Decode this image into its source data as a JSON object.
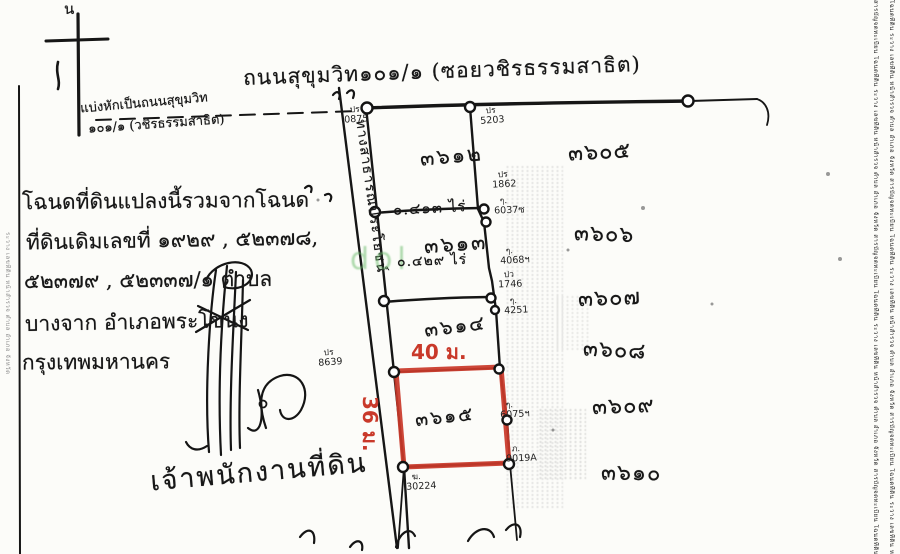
{
  "north_label": "น",
  "road_label": "ถนนสุขุมวิท๑๐๑/๑ (ซอยวชิรธรรมสาธิต)",
  "split_note": {
    "line1": "แบ่งหักเป็นถนนสุขุมวิท",
    "line2": "๑๐๑/๑ (วชิรธรรมสาธิต)"
  },
  "deed_note": {
    "lines": [
      "โฉนดที่ดินแปลงนี้รวมจากโฉนด",
      "ที่ดินเดิมเลขที่ ๑๙๒๙ , ๕๒๓๗๘,",
      "๕๒๓๗๙ , ๕๒๓๓๗/๑ ตำบล",
      "บางจาก อำเภอพระโขนง",
      "กรุงเทพมหานคร"
    ]
  },
  "public_way_label": "ทางสาธารณประโยชน์",
  "officer_label": "เจ้าพนักงานที่ดิน",
  "watermark": "dol",
  "dimensions": {
    "width_label": "40 ม.",
    "height_label": "36 ม."
  },
  "parcels": {
    "strip": [
      {
        "number": "๓๖๑๒",
        "area": "๐.๔๑๓ ไร่"
      },
      {
        "number": "๓๖๑๓",
        "area": "๐.๔๒๙ ไร่"
      },
      {
        "number": "๓๖๑๔",
        "area": ""
      }
    ],
    "highlighted": {
      "number": "๓๖๑๕"
    }
  },
  "neighbor_parcels": [
    "๓๖๐๕",
    "๓๖๐๖",
    "๓๖๐๗",
    "๓๖๐๘",
    "๓๖๐๙",
    "๓๖๑๐"
  ],
  "boundary_marks": [
    {
      "prefix": "ปร",
      "number": "0875"
    },
    {
      "prefix": "ปร",
      "number": "5203"
    },
    {
      "prefix": "ปร",
      "number": "1862"
    },
    {
      "prefix": "ๆ.",
      "number": "6037ซ"
    },
    {
      "prefix": "ๆ.",
      "number": "4068ฯ"
    },
    {
      "prefix": "ปว",
      "number": "1746"
    },
    {
      "prefix": "ๆ.",
      "number": "4251"
    },
    {
      "prefix": "ปร",
      "number": "8639"
    },
    {
      "prefix": "ๆ.",
      "number": "6075ฯ"
    },
    {
      "prefix": "ภ.",
      "number": "9019A"
    },
    {
      "prefix": "ฆ.",
      "number": "30224"
    }
  ],
  "margin_text_right_1": "สารบัญจดทะเบียน โฉนดที่ดิน ระวาง เลขที่ดิน หน้าสำรวจ ตำบล อำเภอ จังหวัด สารบัญจดทะเบียน โฉนดที่ดิน ระวาง เลขที่ดิน หน้าสำรวจ ตำบล อำเภอ จังหวัด สารบัญจดทะเบียน โฉนดที่ดิน ระวาง เลขที่ดิน",
  "margin_text_right_2": "โฉนดที่ดิน ระวาง เลขที่ดิน หน้าสำรวจ ตำบล อำเภอ จังหวัด สารบัญจดทะเบียน โฉนดที่ดิน ระวาง เลขที่ดิน หน้าสำรวจ ตำบล อำเภอ จังหวัด สารบัญจดทะเบียน โฉนดที่ดิน ระวาง เลขที่ดิน หน้าสำรวจ",
  "margin_text_left": "ระวาง เลขที่ดิน หน้าสำรวจ ตำบล อำเภอ จังหวัด",
  "colors": {
    "highlight_red": "#c9392a",
    "watermark_green": "#6fbe6f",
    "ink": "#1b1b1b",
    "paper": "#fcfcf9"
  }
}
